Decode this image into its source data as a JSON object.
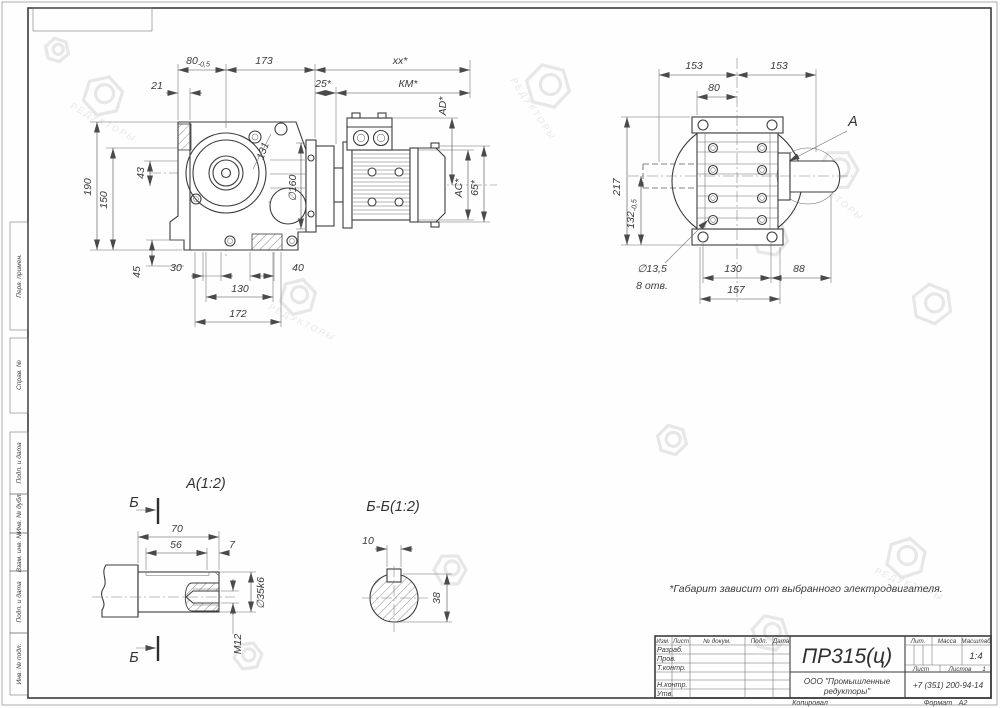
{
  "wm": "РЕДУКТОРЫ",
  "note": "*Габарит зависит от выбранного электродвигателя.",
  "side": {
    "d80": "80",
    "d80t": "-0,5",
    "d173": "173",
    "dxx": "xx*",
    "d21": "21",
    "d25": "25*",
    "dkm": "КМ*",
    "dad": "AD*",
    "dac": "AC*",
    "d65": "65*",
    "d190": "190",
    "d150": "150",
    "d43": "43",
    "d45": "45",
    "d30": "30",
    "d40": "40",
    "d130": "130",
    "d172": "172",
    "d131": "131",
    "d160": "∅160"
  },
  "front": {
    "d153a": "153",
    "d153b": "153",
    "d80": "80",
    "d217": "217",
    "d132": "132",
    "d132t": "-0,5",
    "d130": "130",
    "d88": "88",
    "d157": "157",
    "dholes": "∅13,5",
    "dholes2": "8 отв.",
    "label_a": "А"
  },
  "detail": {
    "title": "А(1:2)",
    "sec": "Б",
    "d70": "70",
    "d56": "56",
    "d7": "7",
    "d35": "∅35k6",
    "dm12": "M12"
  },
  "secb": {
    "title": "Б-Б(1:2)",
    "d10": "10",
    "d38": "38"
  },
  "margin": [
    "Перв. примен.",
    "Справ. №",
    "Подп. и дата",
    "Инв. № дубл.",
    "Взам. инв. №",
    "Подп. и дата",
    "Инв. № подл."
  ],
  "tb": {
    "c_izm": "Изм.",
    "c_list": "Лист",
    "c_ndoc": "№ докум.",
    "c_podp": "Подп.",
    "c_data": "Дата",
    "r1": "Разраб.",
    "r2": "Пров.",
    "r3": "Т.контр.",
    "r4": "Н.контр.",
    "r5": "Утв.",
    "title": "ПР315(ц)",
    "lit": "Лит.",
    "mass": "Масса",
    "scale": "Масштаб",
    "scale_v": "1:4",
    "list": "Лист",
    "listov": "Листов",
    "listov_v": "1",
    "org1": "ООО \"Промышленные",
    "org2": "редукторы\"",
    "phone": "+7 (351) 200-94-14",
    "copied": "Копировал",
    "format": "Формат",
    "format_v": "А2"
  }
}
